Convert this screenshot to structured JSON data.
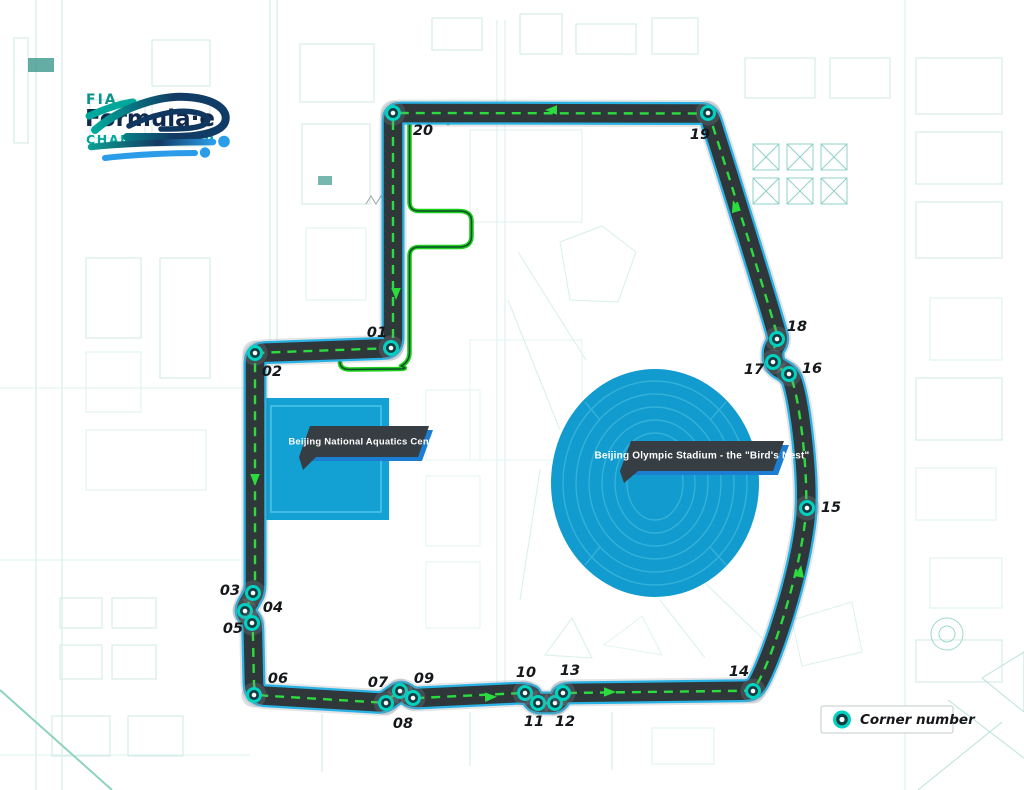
{
  "logo": {
    "fia": "FIA",
    "formula_e": "Formula·e",
    "championship": "CHAMPIONSHIP"
  },
  "landmarks": {
    "aquatics": "Beijing National Aquatics Centre",
    "stadium": "Beijing Olympic Stadium - the \"Bird's Nest\""
  },
  "legend": {
    "corner_number": "Corner number"
  },
  "colors": {
    "track_dark": "#2f373a",
    "track_edge_blue": "#29b2e4",
    "racing_line_green": "#2bdc3e",
    "pit_lane_green": "#1fce1c",
    "marker_ring": "#00d2c2",
    "marker_core": "#113c41",
    "marker_center": "#ffffff",
    "landmark_blue": "#13a0d3",
    "banner_dark": "#363d43",
    "banner_accent_blue": "#1b7ed3",
    "map_line_teal": "#cfeae5"
  },
  "corners": [
    {
      "num": "01",
      "m": [
        391,
        348
      ],
      "l": [
        377,
        333
      ]
    },
    {
      "num": "02",
      "m": [
        255,
        353
      ],
      "l": [
        272,
        372
      ]
    },
    {
      "num": "03",
      "m": [
        253,
        593
      ],
      "l": [
        230,
        591
      ]
    },
    {
      "num": "04",
      "m": [
        245,
        611
      ],
      "l": [
        273,
        608
      ]
    },
    {
      "num": "05",
      "m": [
        252,
        623
      ],
      "l": [
        233,
        629
      ]
    },
    {
      "num": "06",
      "m": [
        254,
        695
      ],
      "l": [
        278,
        679
      ]
    },
    {
      "num": "07",
      "m": [
        386,
        703
      ],
      "l": [
        378,
        683
      ]
    },
    {
      "num": "08",
      "m": [
        400,
        691
      ],
      "l": [
        403,
        724
      ]
    },
    {
      "num": "09",
      "m": [
        413,
        698
      ],
      "l": [
        424,
        679
      ]
    },
    {
      "num": "10",
      "m": [
        525,
        693
      ],
      "l": [
        526,
        673
      ]
    },
    {
      "num": "11",
      "m": [
        538,
        703
      ],
      "l": [
        534,
        722
      ]
    },
    {
      "num": "12",
      "m": [
        555,
        703
      ],
      "l": [
        565,
        722
      ]
    },
    {
      "num": "13",
      "m": [
        563,
        693
      ],
      "l": [
        570,
        671
      ]
    },
    {
      "num": "14",
      "m": [
        753,
        691
      ],
      "l": [
        739,
        672
      ]
    },
    {
      "num": "15",
      "m": [
        807,
        508
      ],
      "l": [
        831,
        508
      ]
    },
    {
      "num": "16",
      "m": [
        789,
        374
      ],
      "l": [
        812,
        369
      ]
    },
    {
      "num": "17",
      "m": [
        773,
        362
      ],
      "l": [
        754,
        370
      ]
    },
    {
      "num": "18",
      "m": [
        777,
        339
      ],
      "l": [
        797,
        327
      ]
    },
    {
      "num": "19",
      "m": [
        708,
        113
      ],
      "l": [
        700,
        135
      ]
    },
    {
      "num": "20",
      "m": [
        393,
        113
      ],
      "l": [
        423,
        131
      ]
    }
  ]
}
